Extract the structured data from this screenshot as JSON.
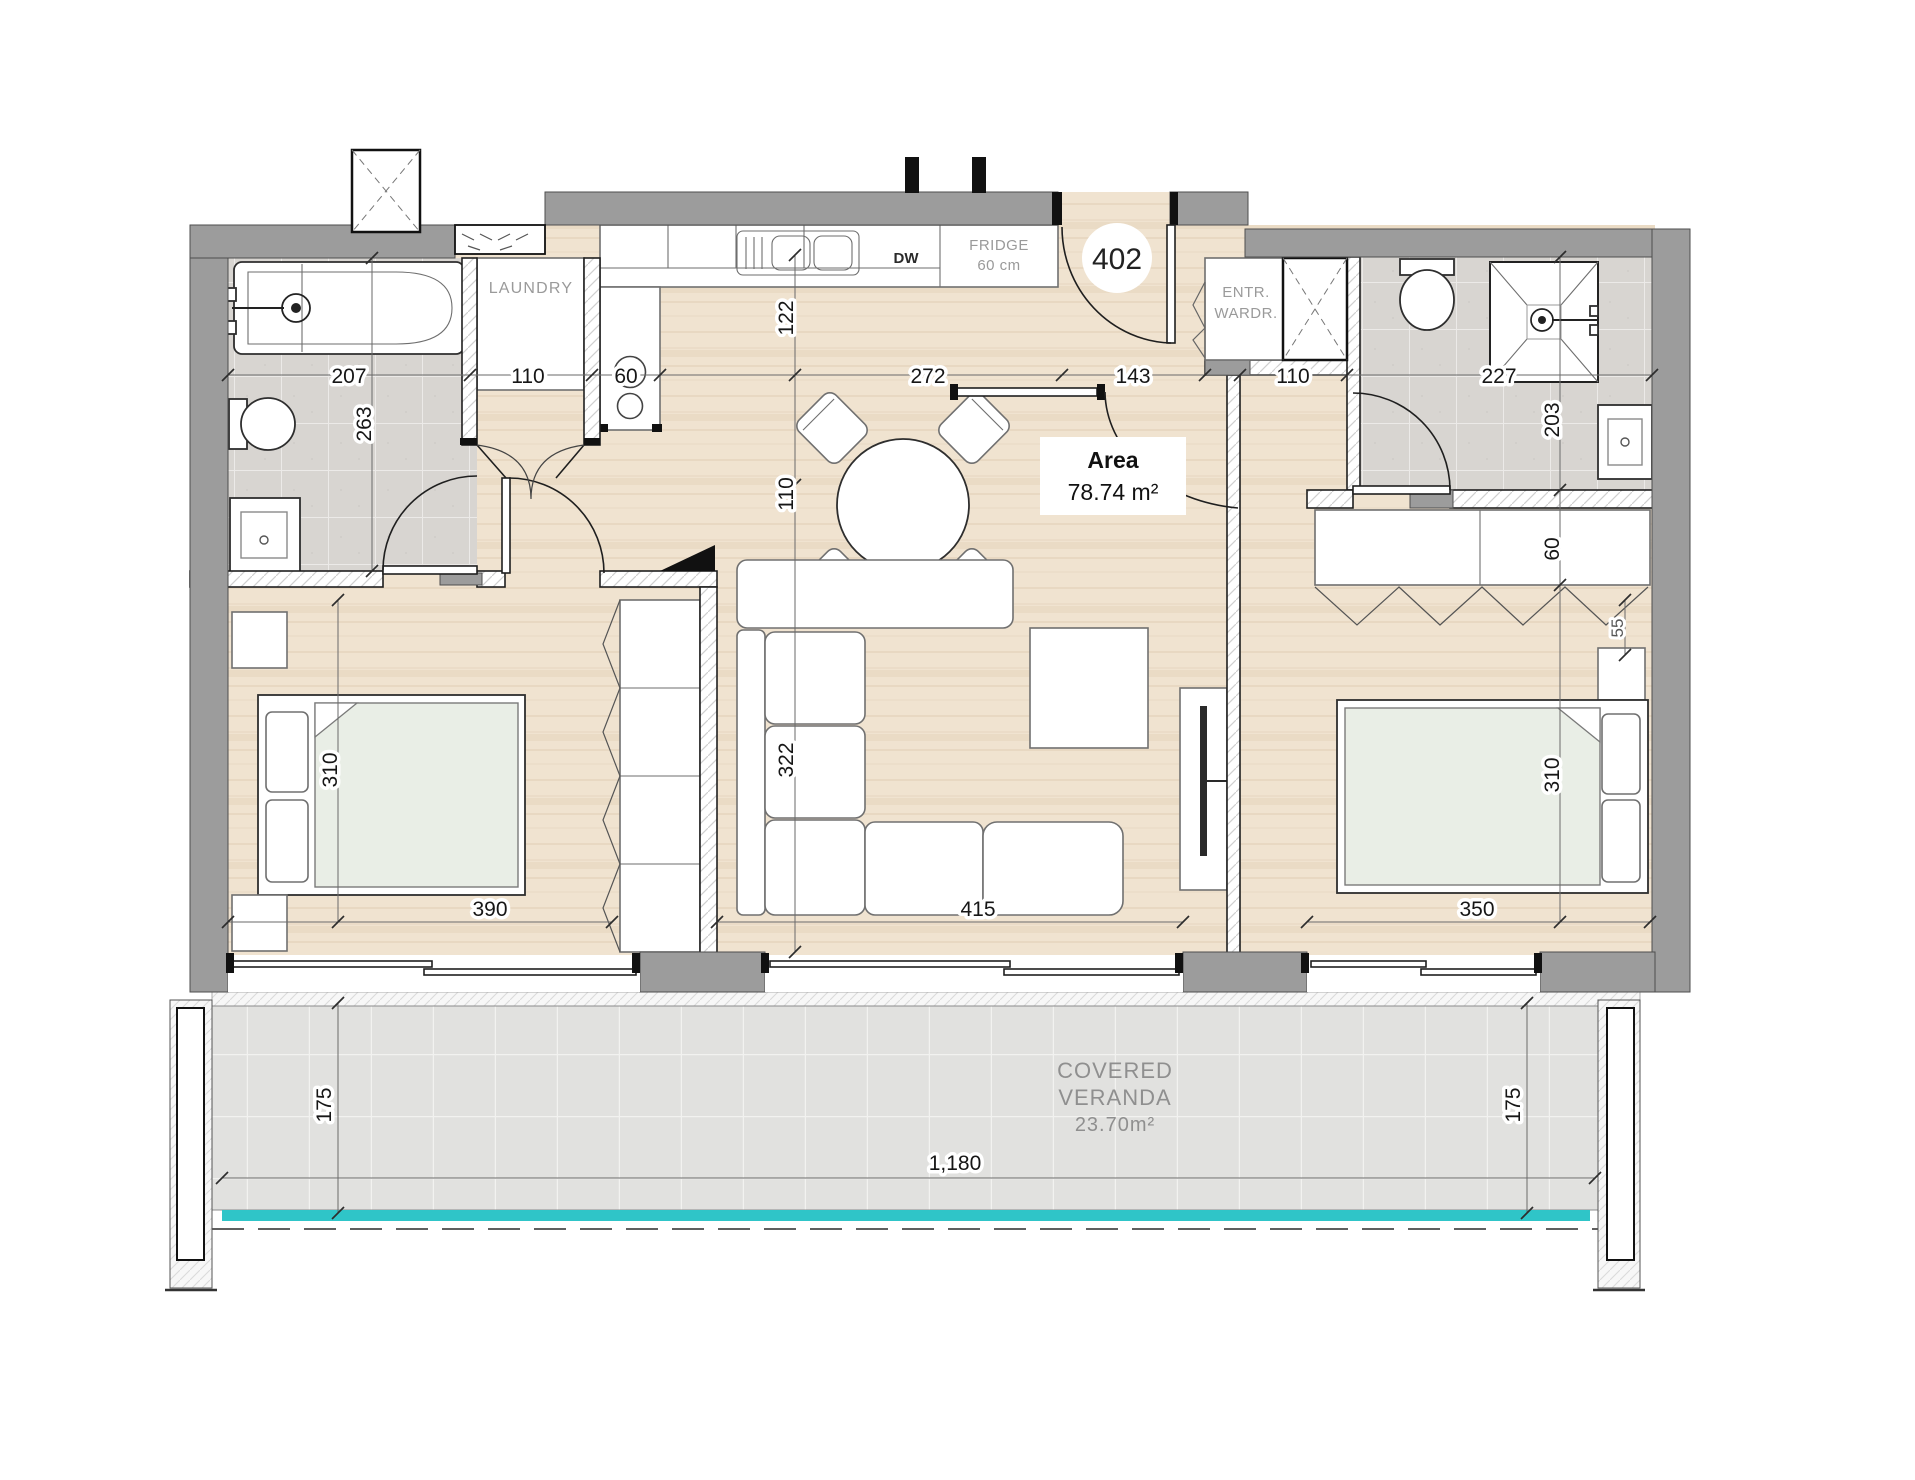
{
  "unit": {
    "number": "402"
  },
  "area": {
    "label": "Area",
    "value": "78.74 m²"
  },
  "rooms": {
    "laundry": "LAUNDRY",
    "fridge_line1": "FRIDGE",
    "fridge_line2": "60 cm",
    "dishwasher": "DW",
    "wardrobe_line1": "ENTR.",
    "wardrobe_line2": "WARDR."
  },
  "veranda": {
    "line1": "COVERED",
    "line2": "VERANDA",
    "area": "23.70m²",
    "width": "1,180",
    "depth_left": "175",
    "depth_right": "175"
  },
  "dims": {
    "bath1_width": "207",
    "bath1_depth": "263",
    "laundry_width": "110",
    "hob_width": "60",
    "kitchen_clear": "122",
    "aisle_width": "110",
    "dining_width": "272",
    "hall_width": "143",
    "nook_width": "110",
    "bath2_width": "227",
    "bath2_depth": "203",
    "bed1_depth": "310",
    "bed1_width": "390",
    "living_depth": "322",
    "living_width": "415",
    "bed2_width": "350",
    "bed2_depth": "310",
    "wardrobe2_depth": "60",
    "nightstand_width": "55"
  },
  "colors": {
    "wall_gray": "#9c9c9c",
    "wood_floor": "#f0e3d0",
    "bath_tile": "#d8d5d1",
    "veranda_tile": "#e1e1df",
    "balustrade_teal": "#2fc5c8",
    "label_gray": "#9a9a9a",
    "ink": "#161616"
  }
}
